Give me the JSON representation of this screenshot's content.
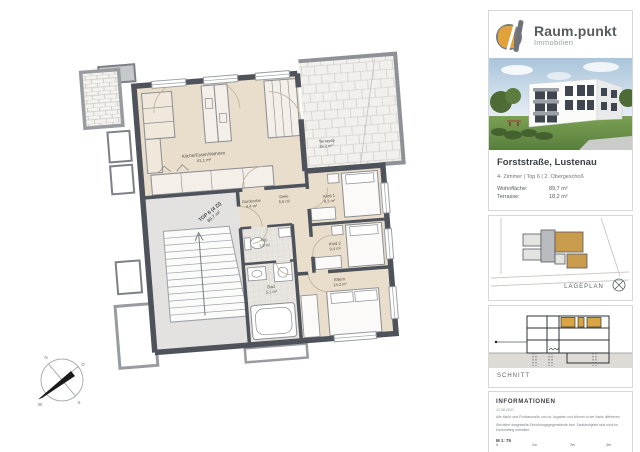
{
  "brand": {
    "name": "Raum.punkt",
    "subtitle": "Immobilien"
  },
  "listing": {
    "title": "Forststraße, Lustenau",
    "subtitle": "4- Zimmer  |  Top 6  |  2. Obergeschoß",
    "living_label": "Wohnfläche:",
    "living_value": "89,7 m²",
    "terrace_label": "Terrasse:",
    "terrace_value": "18,2 m²"
  },
  "plan": {
    "unit_line1": "TOP 6 (4 Zi)",
    "unit_line2": "89,7 m²",
    "rooms": {
      "kitchen": {
        "name": "Küche/Essen/Wohnen",
        "area": "41,1 m²"
      },
      "terrace": {
        "name": "Terrasse",
        "area": "18,2 m²"
      },
      "garderobe": {
        "name": "Garderobe",
        "area": "4,4 m²"
      },
      "diele": {
        "name": "Diele",
        "area": "5,6 m²"
      },
      "kind1": {
        "name": "Kind 1",
        "area": "9,3 m²"
      },
      "kind2": {
        "name": "Kind 2",
        "area": "9,4 m²"
      },
      "eltern": {
        "name": "Eltern",
        "area": "14,2 m²"
      },
      "bad": {
        "name": "Bad",
        "area": "5,1 m²"
      },
      "wc": {
        "name": "WC",
        "area": "1,9 m²"
      }
    }
  },
  "sections": {
    "lageplan": "LAGEPLAN",
    "schnitt": "SCHNITT"
  },
  "info": {
    "heading": "INFORMATIONEN",
    "date": "12.08.2021",
    "note1": "Alle Maße sind Rohbaumaße und ca. Angaben und können in der Natur differieren.",
    "note2": "Strichliert dargestellte Einrichtungsgegenstände bzw. Sanitärobjekte sind nicht im Kaufumfang enthalten.",
    "scale": "M 1: 75",
    "scale_ticks": [
      "0",
      "1m",
      "2m",
      "3m"
    ]
  },
  "colors": {
    "accent_orange": "#e2a23b",
    "wall": "#4d525b",
    "room_fill": "#e9ddcc"
  }
}
